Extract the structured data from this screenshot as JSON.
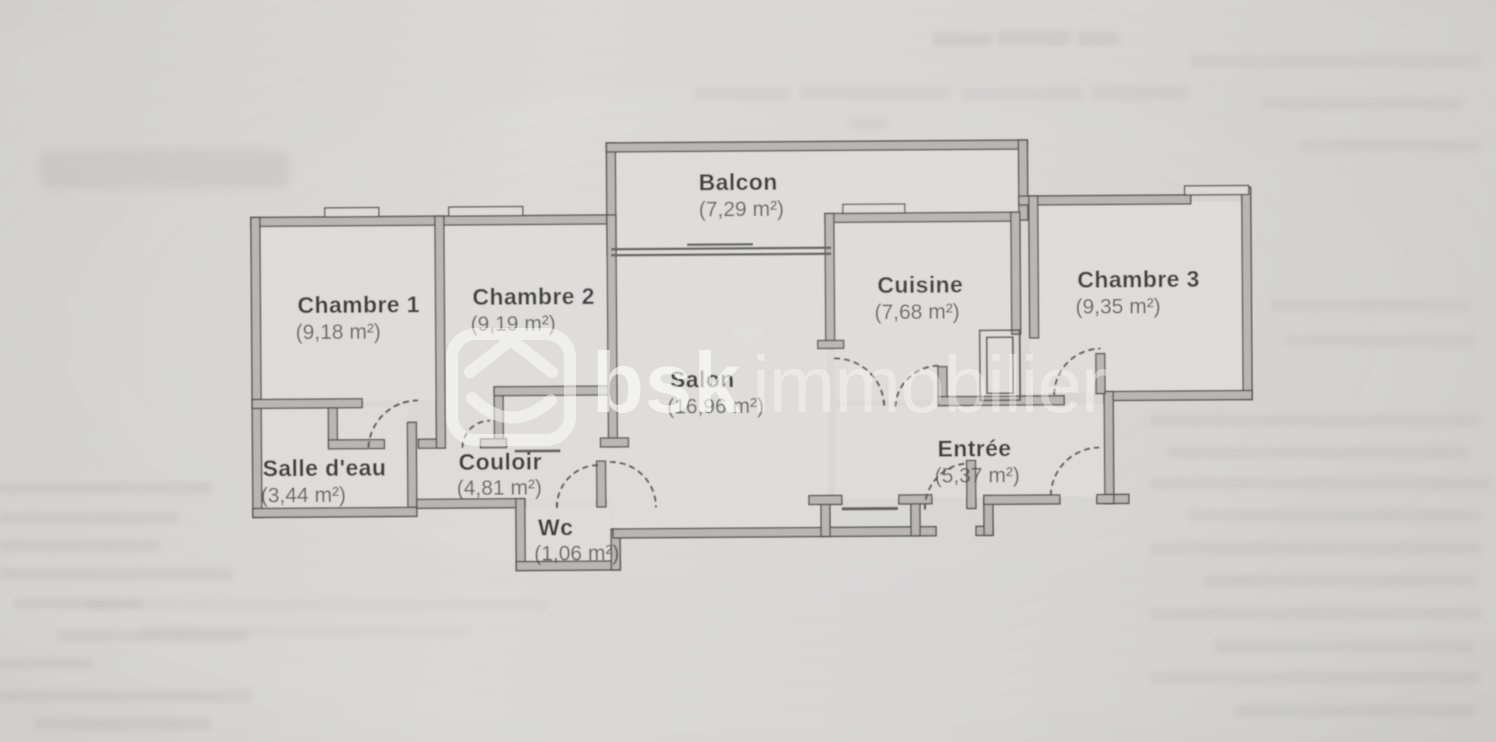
{
  "page": {
    "kind": "scanned-apartment-floor-plan",
    "watermark": {
      "icon": "bsk-house-logo",
      "bold": "bsk",
      "light": "immobilier"
    },
    "rooms": [
      {
        "name": "Balcon",
        "area": "(7,29 m²)"
      },
      {
        "name": "Chambre 1",
        "area": "(9,18 m²)"
      },
      {
        "name": "Chambre 2",
        "area": "(9,19 m²)"
      },
      {
        "name": "Cuisine",
        "area": "(7,68 m²)"
      },
      {
        "name": "Chambre 3",
        "area": "(9,35 m²)"
      },
      {
        "name": "Salon",
        "area": "(16,96 m²)"
      },
      {
        "name": "Salle d'eau",
        "area": "(3,44 m²)"
      },
      {
        "name": "Couloir",
        "area": "(4,81 m²)"
      },
      {
        "name": "Wc",
        "area": "(1,06 m²)"
      },
      {
        "name": "Entrée",
        "area": "(5,37 m²)"
      }
    ],
    "colors": {
      "paper": "#d6d5d3",
      "wall_fill": "#b5b4b2",
      "wall_line": "#4b4b49",
      "label_text": "#38383a",
      "area_text": "#4a4a4c",
      "watermark": "#ffffff"
    }
  }
}
